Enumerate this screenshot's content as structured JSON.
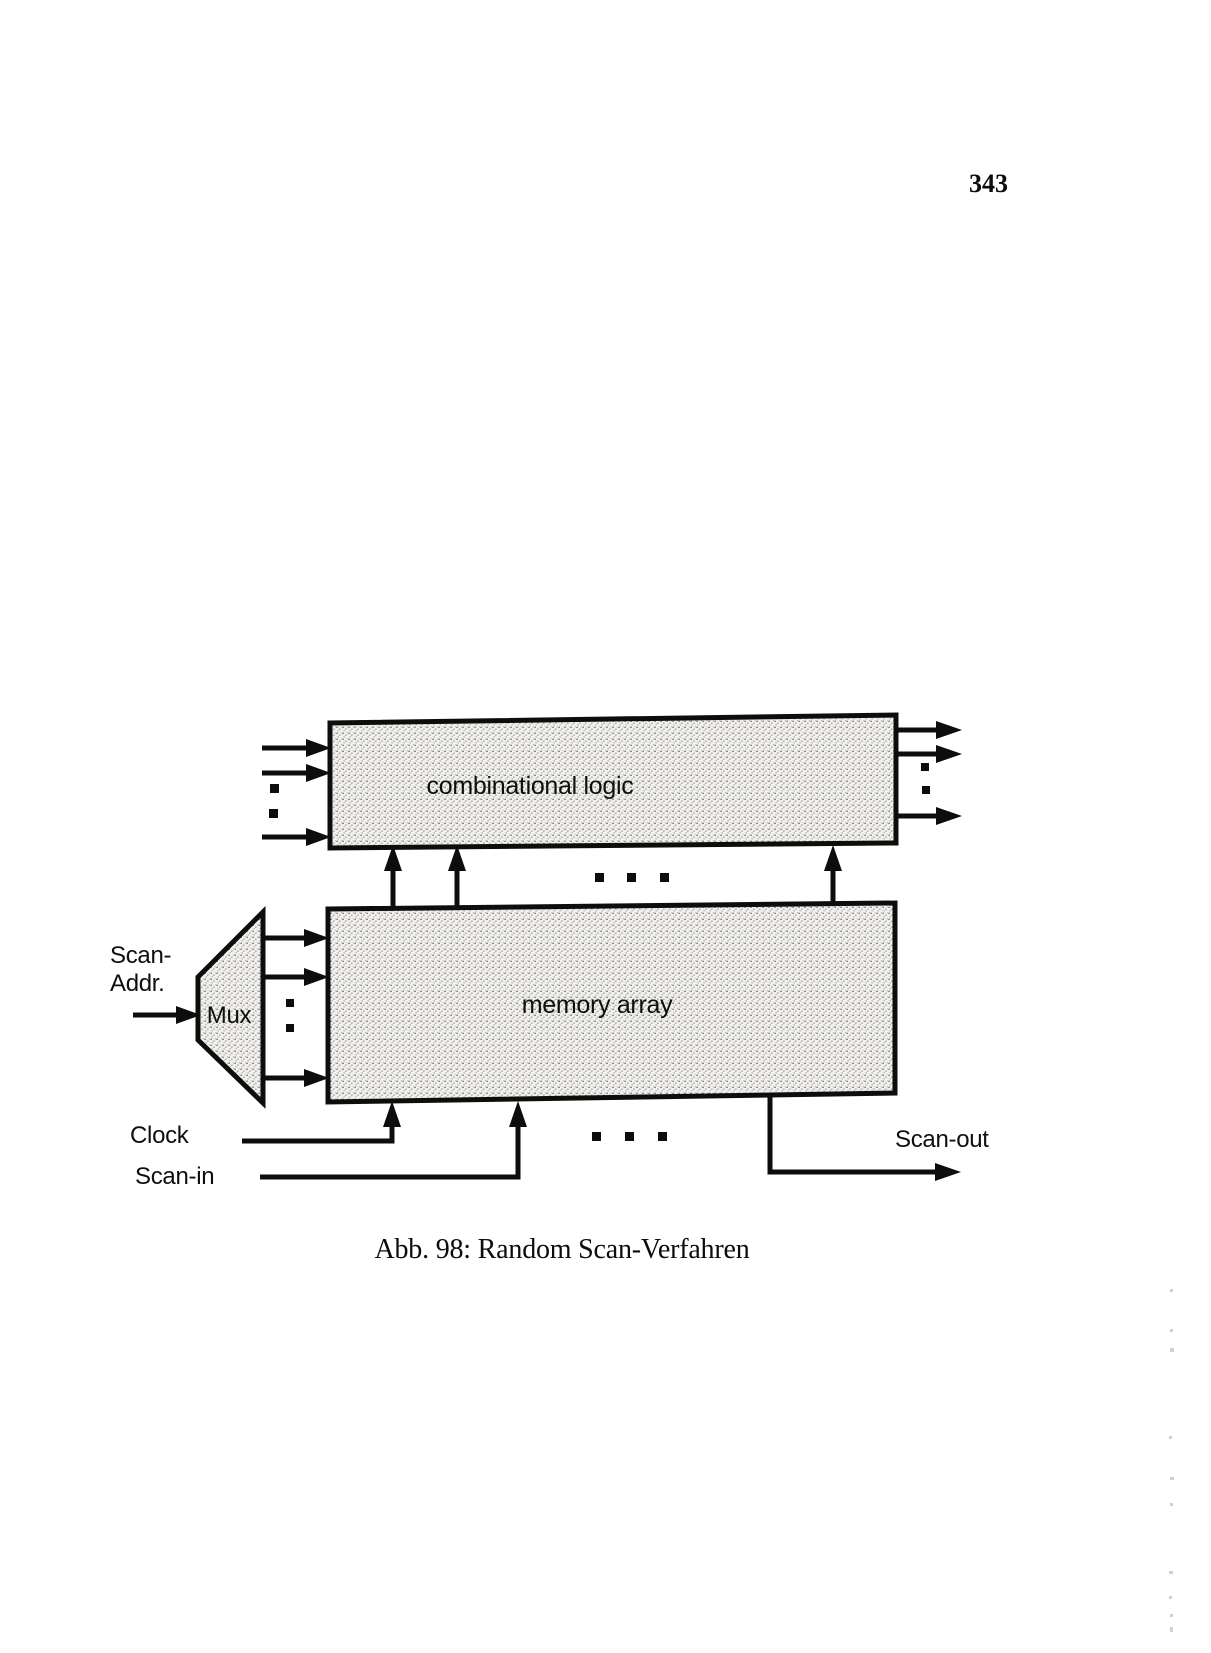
{
  "page": {
    "number": "343"
  },
  "figure": {
    "caption": "Abb. 98: Random Scan-Verfahren",
    "blocks": {
      "combinational_logic": "combinational logic",
      "memory_array": "memory array",
      "mux": "Mux"
    },
    "labels": {
      "scan_addr_line1": "Scan-",
      "scan_addr_line2": "Addr.",
      "clock": "Clock",
      "scan_in": "Scan-in",
      "scan_out": "Scan-out"
    }
  },
  "colors": {
    "ink": "#0d0d0d",
    "paper": "#ffffff",
    "block_fill": "#efeeea",
    "stipple_dot": "#6e6e6e"
  }
}
